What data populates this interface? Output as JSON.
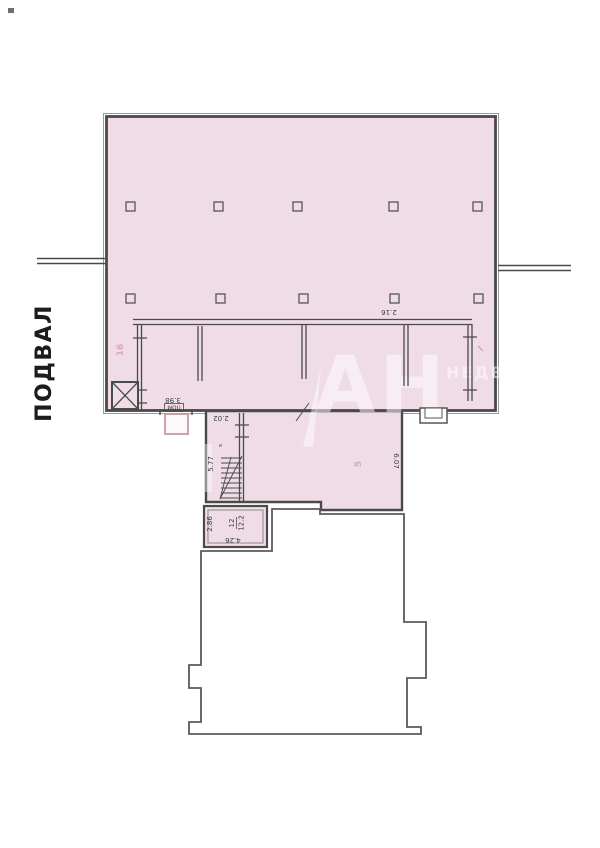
{
  "plan": {
    "title": "ПОДВАЛ",
    "watermark": {
      "line1": "АН",
      "line2": "НЕДВИ"
    },
    "labels": {
      "dim_3_98": "3.98",
      "box_pom": "ПОМ",
      "dim_2_02": "2.02",
      "dim_5_77": "5.77",
      "dim_6_07": "6.07",
      "dim_2_86": "2.86",
      "room_12_number": "12",
      "room_12_area": "12.2",
      "dim_4_26": "4.26",
      "dim_2_16": "2.16",
      "stair_mark": "в",
      "stamp_left": "16",
      "stamp_lower": "5"
    },
    "colors": {
      "room_fill": "#EFDCE6",
      "wall": "#4A4A4A",
      "door_accent": "#C79AA2",
      "stamp": "#CE7C90"
    }
  }
}
